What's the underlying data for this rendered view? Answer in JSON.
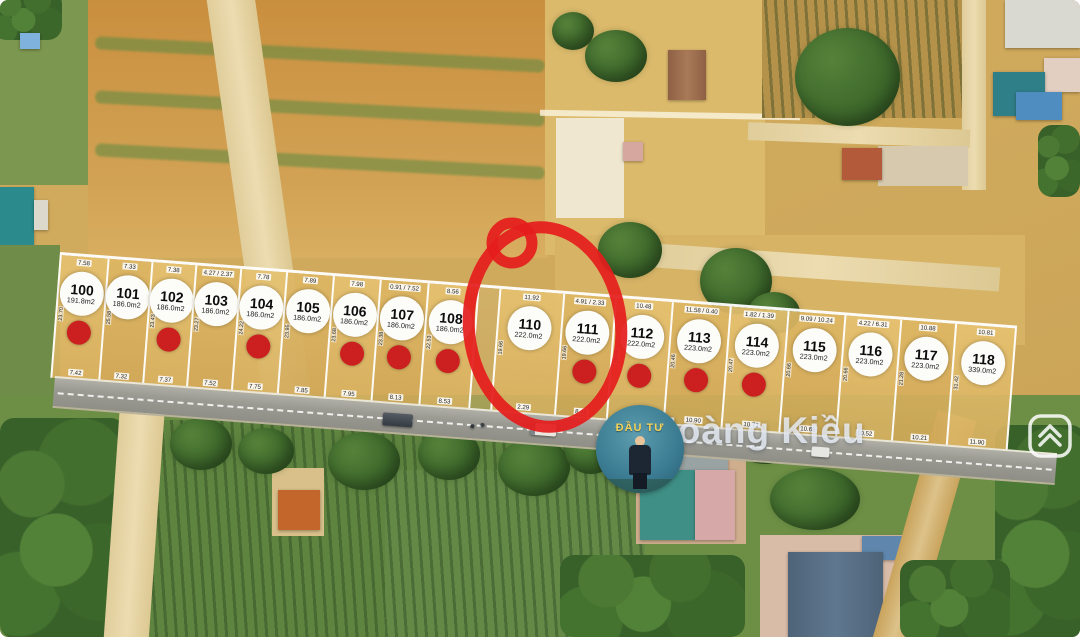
{
  "watermark": {
    "text": "Hoàng Kiều"
  },
  "badge": {
    "text": "ĐẦU TƯ"
  },
  "annotation": {
    "highlighted_plot": "111",
    "color": "#e51c1c"
  },
  "colors": {
    "sold_dot": "#cc1f1f",
    "plot_fill": "#ddb768",
    "road": "#9a9a92"
  },
  "plots": [
    {
      "id": "100",
      "area": "191.8m2",
      "top": "7.58",
      "bottom": "7.42",
      "side": "23.70",
      "sold": true,
      "w": 48
    },
    {
      "id": "101",
      "area": "186.0m2",
      "top": "7.33",
      "bottom": "7.32",
      "side": "25.58",
      "sold": false,
      "w": 44
    },
    {
      "id": "102",
      "area": "186.0m2",
      "top": "7.38",
      "bottom": "7.37",
      "side": "23.43",
      "sold": true,
      "w": 44
    },
    {
      "id": "103",
      "area": "186.0m2",
      "top": "4.27 / 2.37",
      "bottom": "7.52",
      "side": "23.27",
      "sold": false,
      "w": 45
    },
    {
      "id": "104",
      "area": "186.0m2",
      "top": "7.78",
      "bottom": "7.75",
      "side": "24.22",
      "sold": true,
      "w": 46
    },
    {
      "id": "105",
      "area": "186.0m2",
      "top": "7.89",
      "bottom": "7.85",
      "side": "23.95",
      "sold": false,
      "w": 47
    },
    {
      "id": "106",
      "area": "186.0m2",
      "top": "7.98",
      "bottom": "7.95",
      "side": "23.68",
      "sold": true,
      "w": 47
    },
    {
      "id": "107",
      "area": "186.0m2",
      "top": "0.91 / 7.52",
      "bottom": "8.13",
      "side": "23.38",
      "sold": true,
      "w": 48
    },
    {
      "id": "108",
      "area": "186.0m2",
      "top": "8.56",
      "bottom": "8.53",
      "side": "22.53",
      "sold": true,
      "w": 50
    },
    {
      "id": "",
      "area": "",
      "top": "",
      "bottom": "",
      "side": "",
      "sold": false,
      "w": 22,
      "gap": true
    },
    {
      "id": "110",
      "area": "222.0m2",
      "top": "11.92",
      "bottom": "2.29",
      "side": "19.66",
      "sold": false,
      "w": 64
    },
    {
      "id": "111",
      "area": "222.0m2",
      "top": "4.91 / 2.33",
      "bottom": "8.40",
      "side": "19.66",
      "sold": true,
      "w": 52
    },
    {
      "id": "112",
      "area": "222.0m2",
      "top": "10.48",
      "bottom": "11.14",
      "side": "19.08",
      "sold": true,
      "w": 57
    },
    {
      "id": "113",
      "area": "223.0m2",
      "top": "11.58 / 0.40",
      "bottom": "10.90",
      "side": "20.46",
      "sold": true,
      "w": 58
    },
    {
      "id": "114",
      "area": "223.0m2",
      "top": "1.82 / 1.39",
      "bottom": "10.73",
      "side": "20.47",
      "sold": true,
      "w": 58
    },
    {
      "id": "115",
      "area": "223.0m2",
      "top": "9.09 / 10.24",
      "bottom": "10.65",
      "side": "20.66",
      "sold": false,
      "w": 57
    },
    {
      "id": "116",
      "area": "223.0m2",
      "top": "4.22 / 6.31",
      "bottom": "10.52",
      "side": "20.66",
      "sold": false,
      "w": 56
    },
    {
      "id": "117",
      "area": "223.0m2",
      "top": "10.88",
      "bottom": "10.21",
      "side": "21.28",
      "sold": false,
      "w": 55
    },
    {
      "id": "118",
      "area": "339.0m2",
      "top": "10.81",
      "bottom": "11.90",
      "side": "31.42",
      "sold": false,
      "w": 62
    }
  ]
}
